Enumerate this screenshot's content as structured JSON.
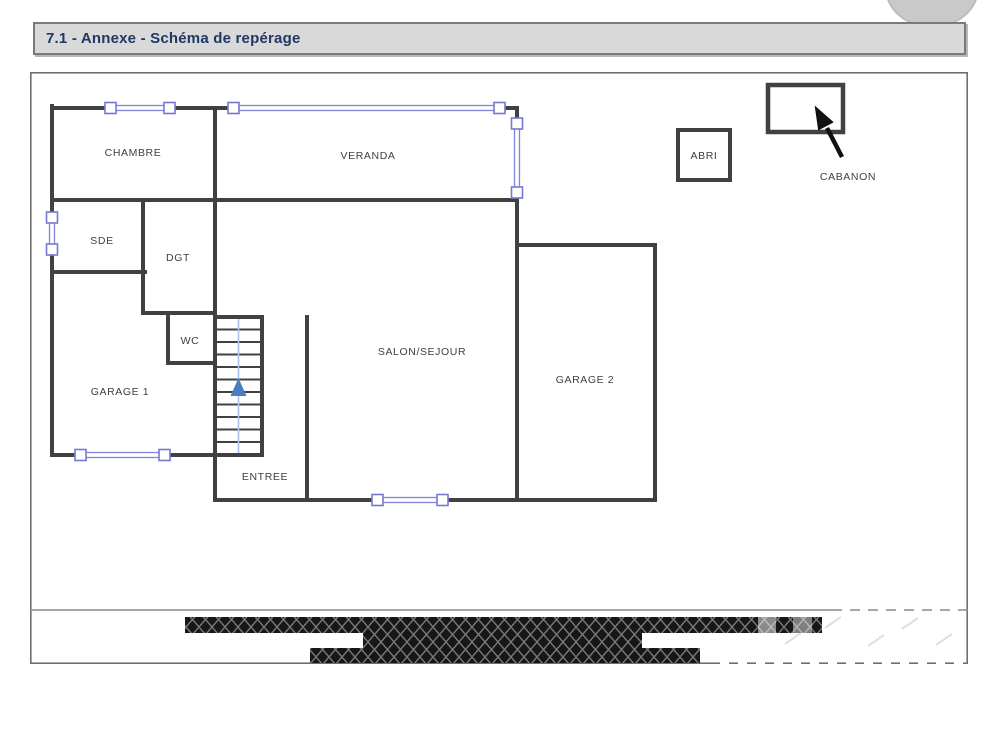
{
  "header": {
    "title": "7.1 - Annexe - Schéma de repérage"
  },
  "floorplan": {
    "rooms": [
      {
        "label": "CHAMBRE"
      },
      {
        "label": "VERANDA"
      },
      {
        "label": "SDE"
      },
      {
        "label": "DGT"
      },
      {
        "label": "WC"
      },
      {
        "label": "GARAGE 1"
      },
      {
        "label": "ENTREE"
      },
      {
        "label": "SALON/SEJOUR"
      },
      {
        "label": "GARAGE 2"
      }
    ],
    "outbuildings": [
      {
        "label": "ABRI"
      },
      {
        "label": "CABANON"
      }
    ],
    "stairs_direction": "up"
  },
  "colors": {
    "wall": "#414141",
    "window_blue": "#8286da",
    "stair_arrow_blue": "#4a7ec0",
    "title_text": "#203864",
    "title_bar_bg": "#d9d9d9",
    "hatch_fill": "#171717"
  }
}
